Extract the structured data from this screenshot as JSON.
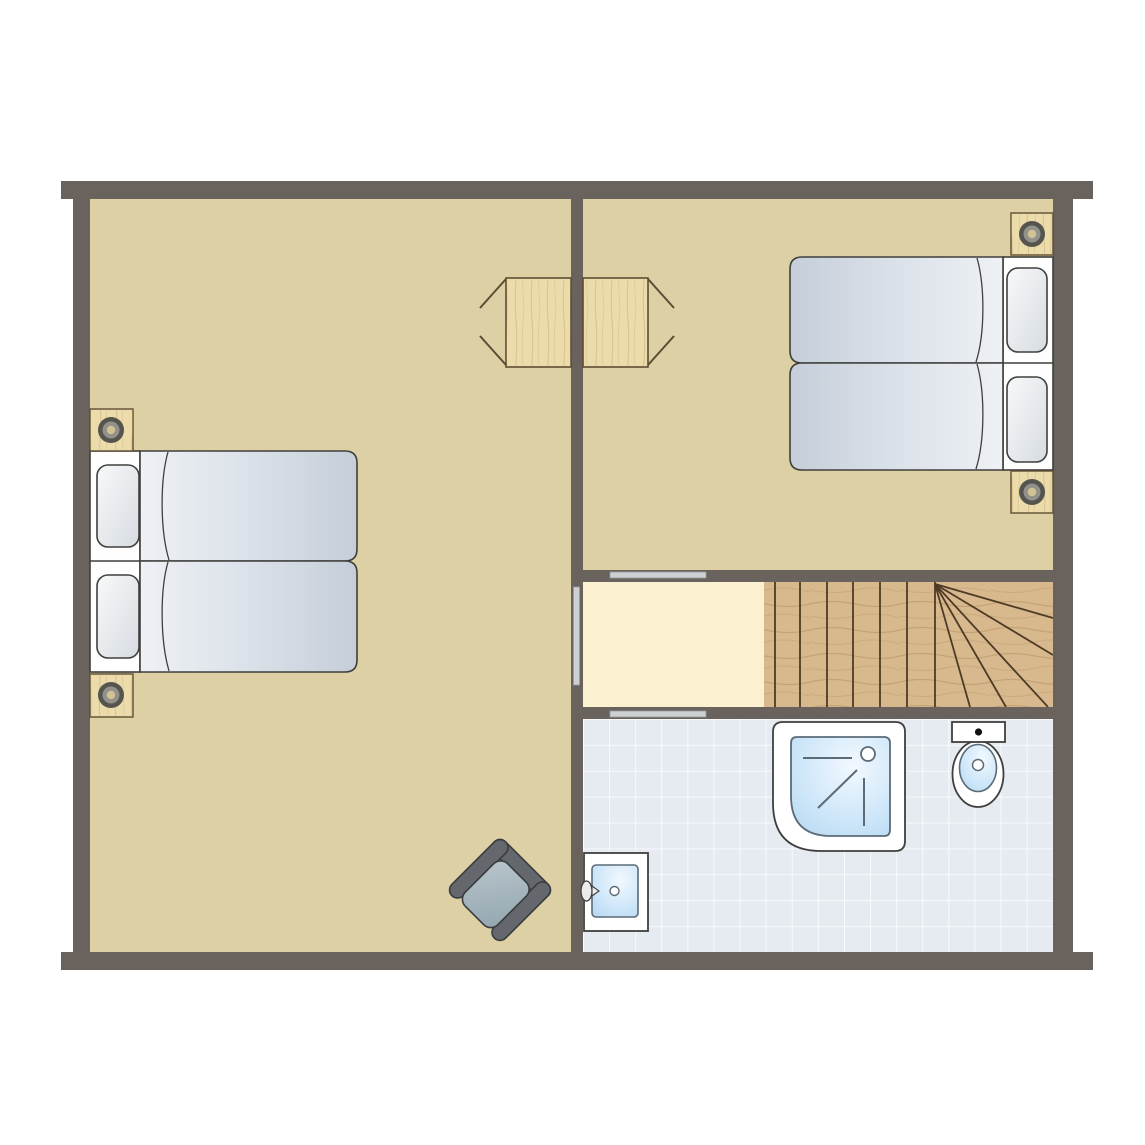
{
  "document": {
    "type": "floor-plan",
    "description": "Upper floor plan with two bedrooms, hallway, winder staircase and bathroom",
    "text_labels": []
  },
  "colors": {
    "wall": "#6a635d",
    "floor_tan": "#dcd0a4",
    "floor_hall": "#fbf1d0",
    "stair_wood": "#d8b98e",
    "stair_line": "#4e3b26",
    "tile_bg": "#e5ebf1",
    "tile_line": "#ffffff",
    "outline": "#3f3f3d",
    "wood_light": "#ecdcab",
    "wood_outline": "#5d4c33",
    "duvet_light": "#eef1f5",
    "duvet_dark": "#c5ced9",
    "bed_base": "#fefefe",
    "door_gray": "#cdd0d2",
    "lamp_outer": "#55544e",
    "lamp_mid": "#92918a",
    "lamp_center": "#d2c294",
    "chair_dark": "#64676c",
    "fixture_line": "#5b6b77",
    "fixture_white": "#ffffff"
  },
  "rooms": [
    {
      "name": "bedroom-left",
      "furniture": [
        {
          "item": "single-bed",
          "count": 2
        },
        {
          "item": "nightstand-with-lamp",
          "count": 2
        },
        {
          "item": "fold-out-wall-table",
          "count": 1
        },
        {
          "item": "armchair",
          "count": 1
        }
      ]
    },
    {
      "name": "bedroom-top-right",
      "furniture": [
        {
          "item": "single-bed",
          "count": 2
        },
        {
          "item": "nightstand-with-lamp",
          "count": 2
        },
        {
          "item": "fold-out-wall-table",
          "count": 1
        }
      ]
    },
    {
      "name": "hallway",
      "furniture": []
    },
    {
      "name": "staircase",
      "straight_treads": 7,
      "winder_steps": 5
    },
    {
      "name": "bathroom",
      "furniture": [
        {
          "item": "shower",
          "count": 1
        },
        {
          "item": "toilet",
          "count": 1
        },
        {
          "item": "washbasin",
          "count": 1
        }
      ]
    }
  ],
  "doors": [
    {
      "location": "bedroom-left-to-hallway",
      "orientation": "vertical"
    },
    {
      "location": "bedroom-top-right-to-hallway",
      "orientation": "horizontal"
    },
    {
      "location": "hallway-to-bathroom",
      "orientation": "horizontal"
    }
  ]
}
